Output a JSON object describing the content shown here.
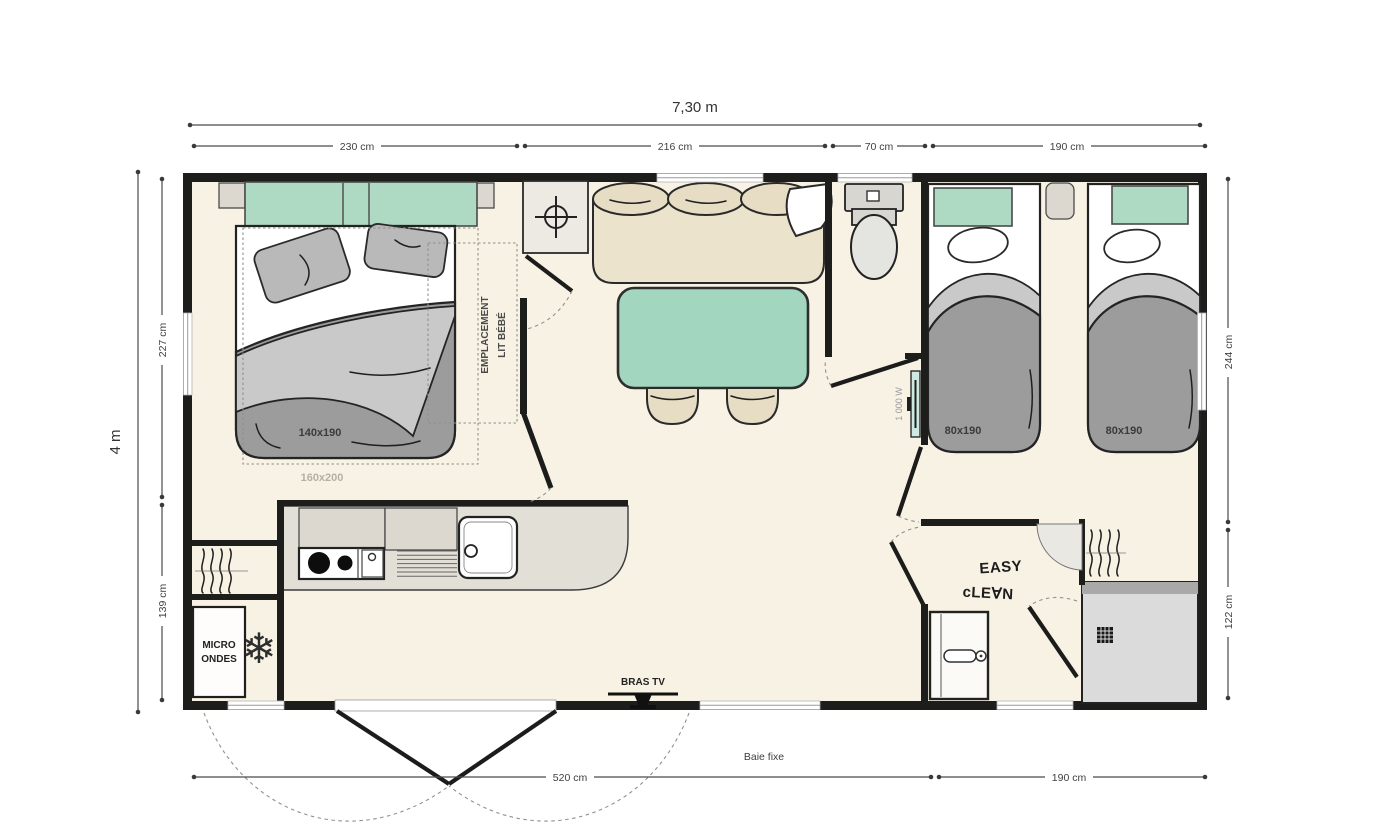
{
  "colors": {
    "wall": "#1d1d1b",
    "floor": "#f7f2e4",
    "green": "#aed9c3",
    "table_green": "#a3d6bf",
    "beige": "#ece3cc",
    "duvet": "#9c9c9c",
    "duvet_light": "#c9c9c9",
    "counter": "#e2dfd7",
    "heater_teal": "#cde9e2",
    "dim_line": "#4a4a4a"
  },
  "dimensions": {
    "overall_width": "7,30 m",
    "overall_height": "4 m",
    "top_segments": [
      "230 cm",
      "216 cm",
      "70 cm",
      "190 cm"
    ],
    "left_segments": [
      "227 cm",
      "139 cm"
    ],
    "right_segments": [
      "244 cm",
      "122 cm"
    ],
    "bottom_segments": [
      "520 cm",
      "190 cm"
    ],
    "fixed_window": "Baie fixe"
  },
  "master_bedroom": {
    "bed_size": "140x190",
    "bed_size_option": "160x200",
    "baby_cot_line1": "EMPLACEMENT",
    "baby_cot_line2": "LIT BÉBÉ"
  },
  "kids_bedroom": {
    "bed1_size": "80x190",
    "bed2_size": "80x190"
  },
  "kitchen": {
    "microwave_line1": "MICRO",
    "microwave_line2": "ONDES",
    "freezer_icon": "❄"
  },
  "living": {
    "tv_label": "BRAS TV"
  },
  "bathroom": {
    "heater_power": "1 000 W",
    "brand_line1": "EASY",
    "brand_line2": "cLE∀N"
  }
}
